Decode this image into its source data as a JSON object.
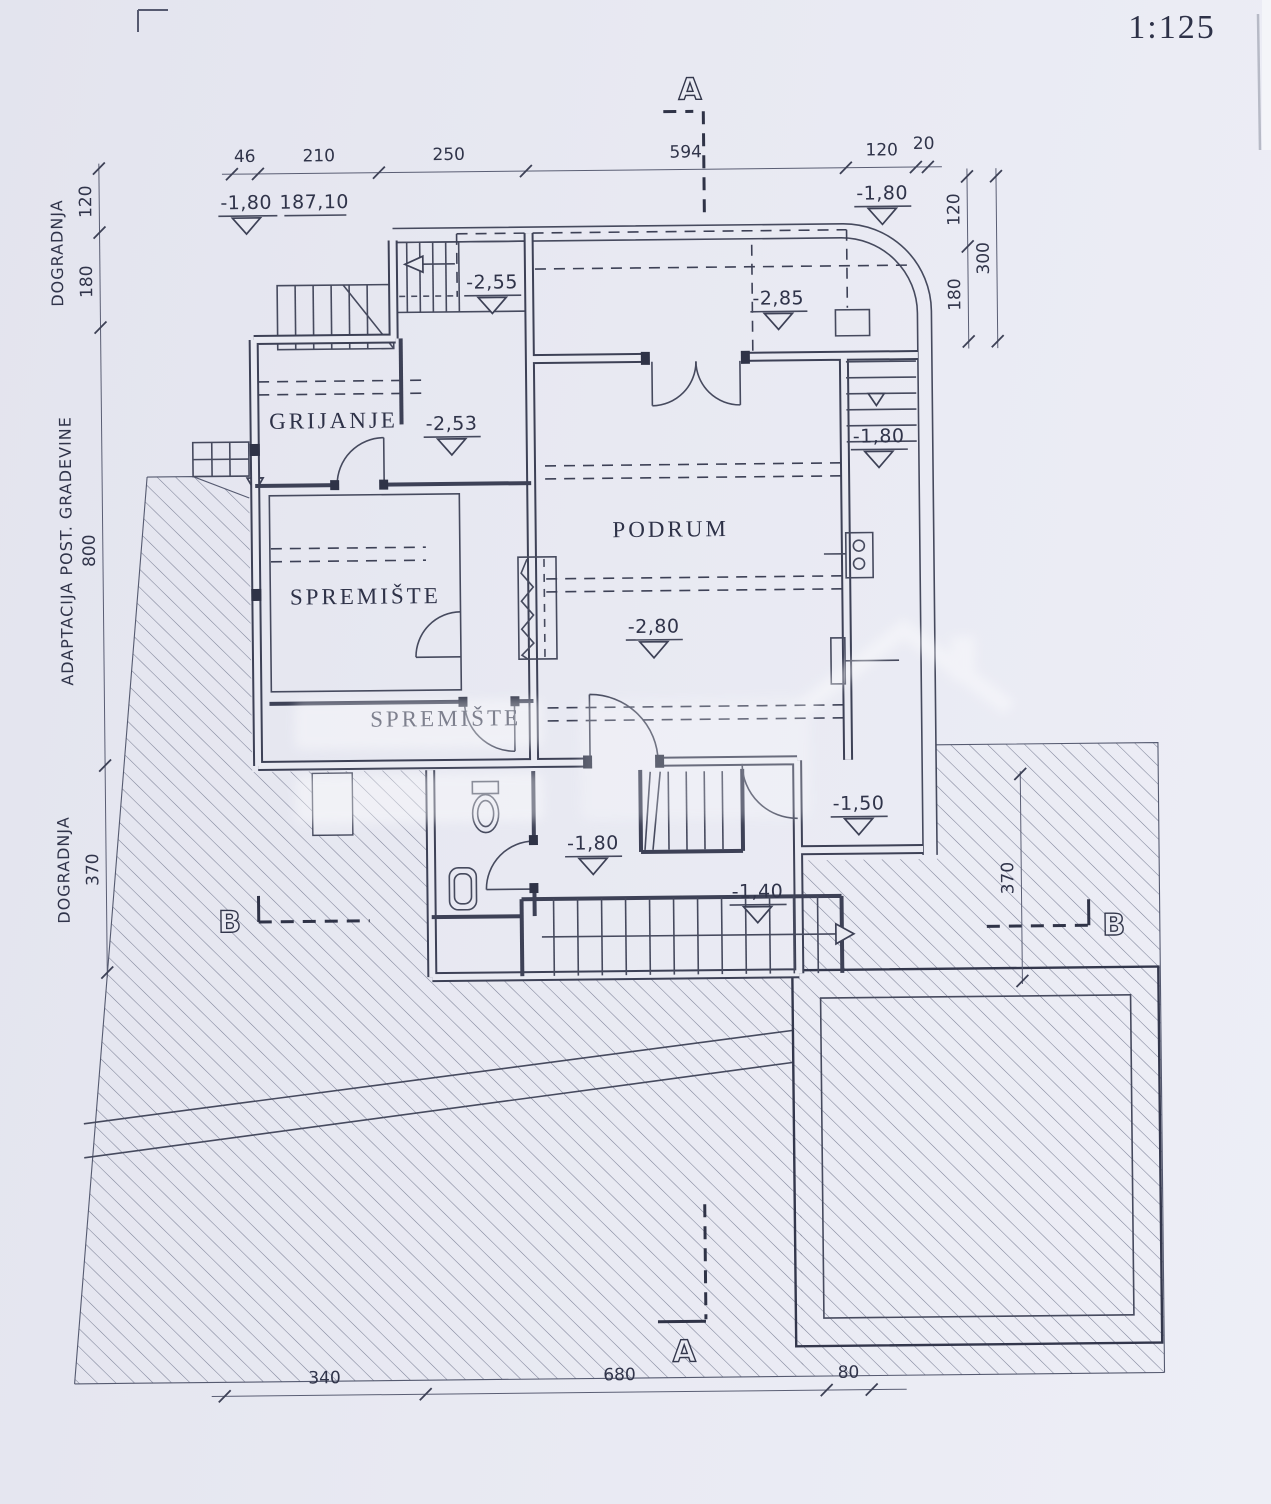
{
  "plan": {
    "scale_label": "1:125",
    "section_markers": {
      "a": "A",
      "b": "B"
    },
    "rooms": {
      "heating": "GRIJANJE",
      "basement": "PODRUM",
      "storage_upper": "SPREMIŠTE",
      "storage_lower": "SPREMIŠTE"
    },
    "levels": {
      "entry_left": "-1,80",
      "entry_left_abs": "187,10",
      "entry_right": "-1,80",
      "stair_top": "-2,55",
      "porch": "-2,85",
      "heating_room": "-2,53",
      "basement_floor": "-2,80",
      "east_stairs": "-1,80",
      "landing": "-1,50",
      "hall": "-1,80",
      "mid_landing": "-1,40"
    },
    "dimensions": {
      "top": [
        "46",
        "210",
        "250",
        "594",
        "120",
        "20"
      ],
      "left": [
        "120",
        "180",
        "800",
        "370"
      ],
      "left_annotations": [
        "DOGRADNJA",
        "ADAPTACIJA POST. GRADEVINE",
        "DOGRADNJA"
      ],
      "right": [
        "120",
        "180",
        "300"
      ],
      "right_lower": "370",
      "bottom": [
        "340",
        "680",
        "80"
      ]
    },
    "colors": {
      "paper": "#e8e9f1",
      "ink": "#3d4156"
    }
  }
}
